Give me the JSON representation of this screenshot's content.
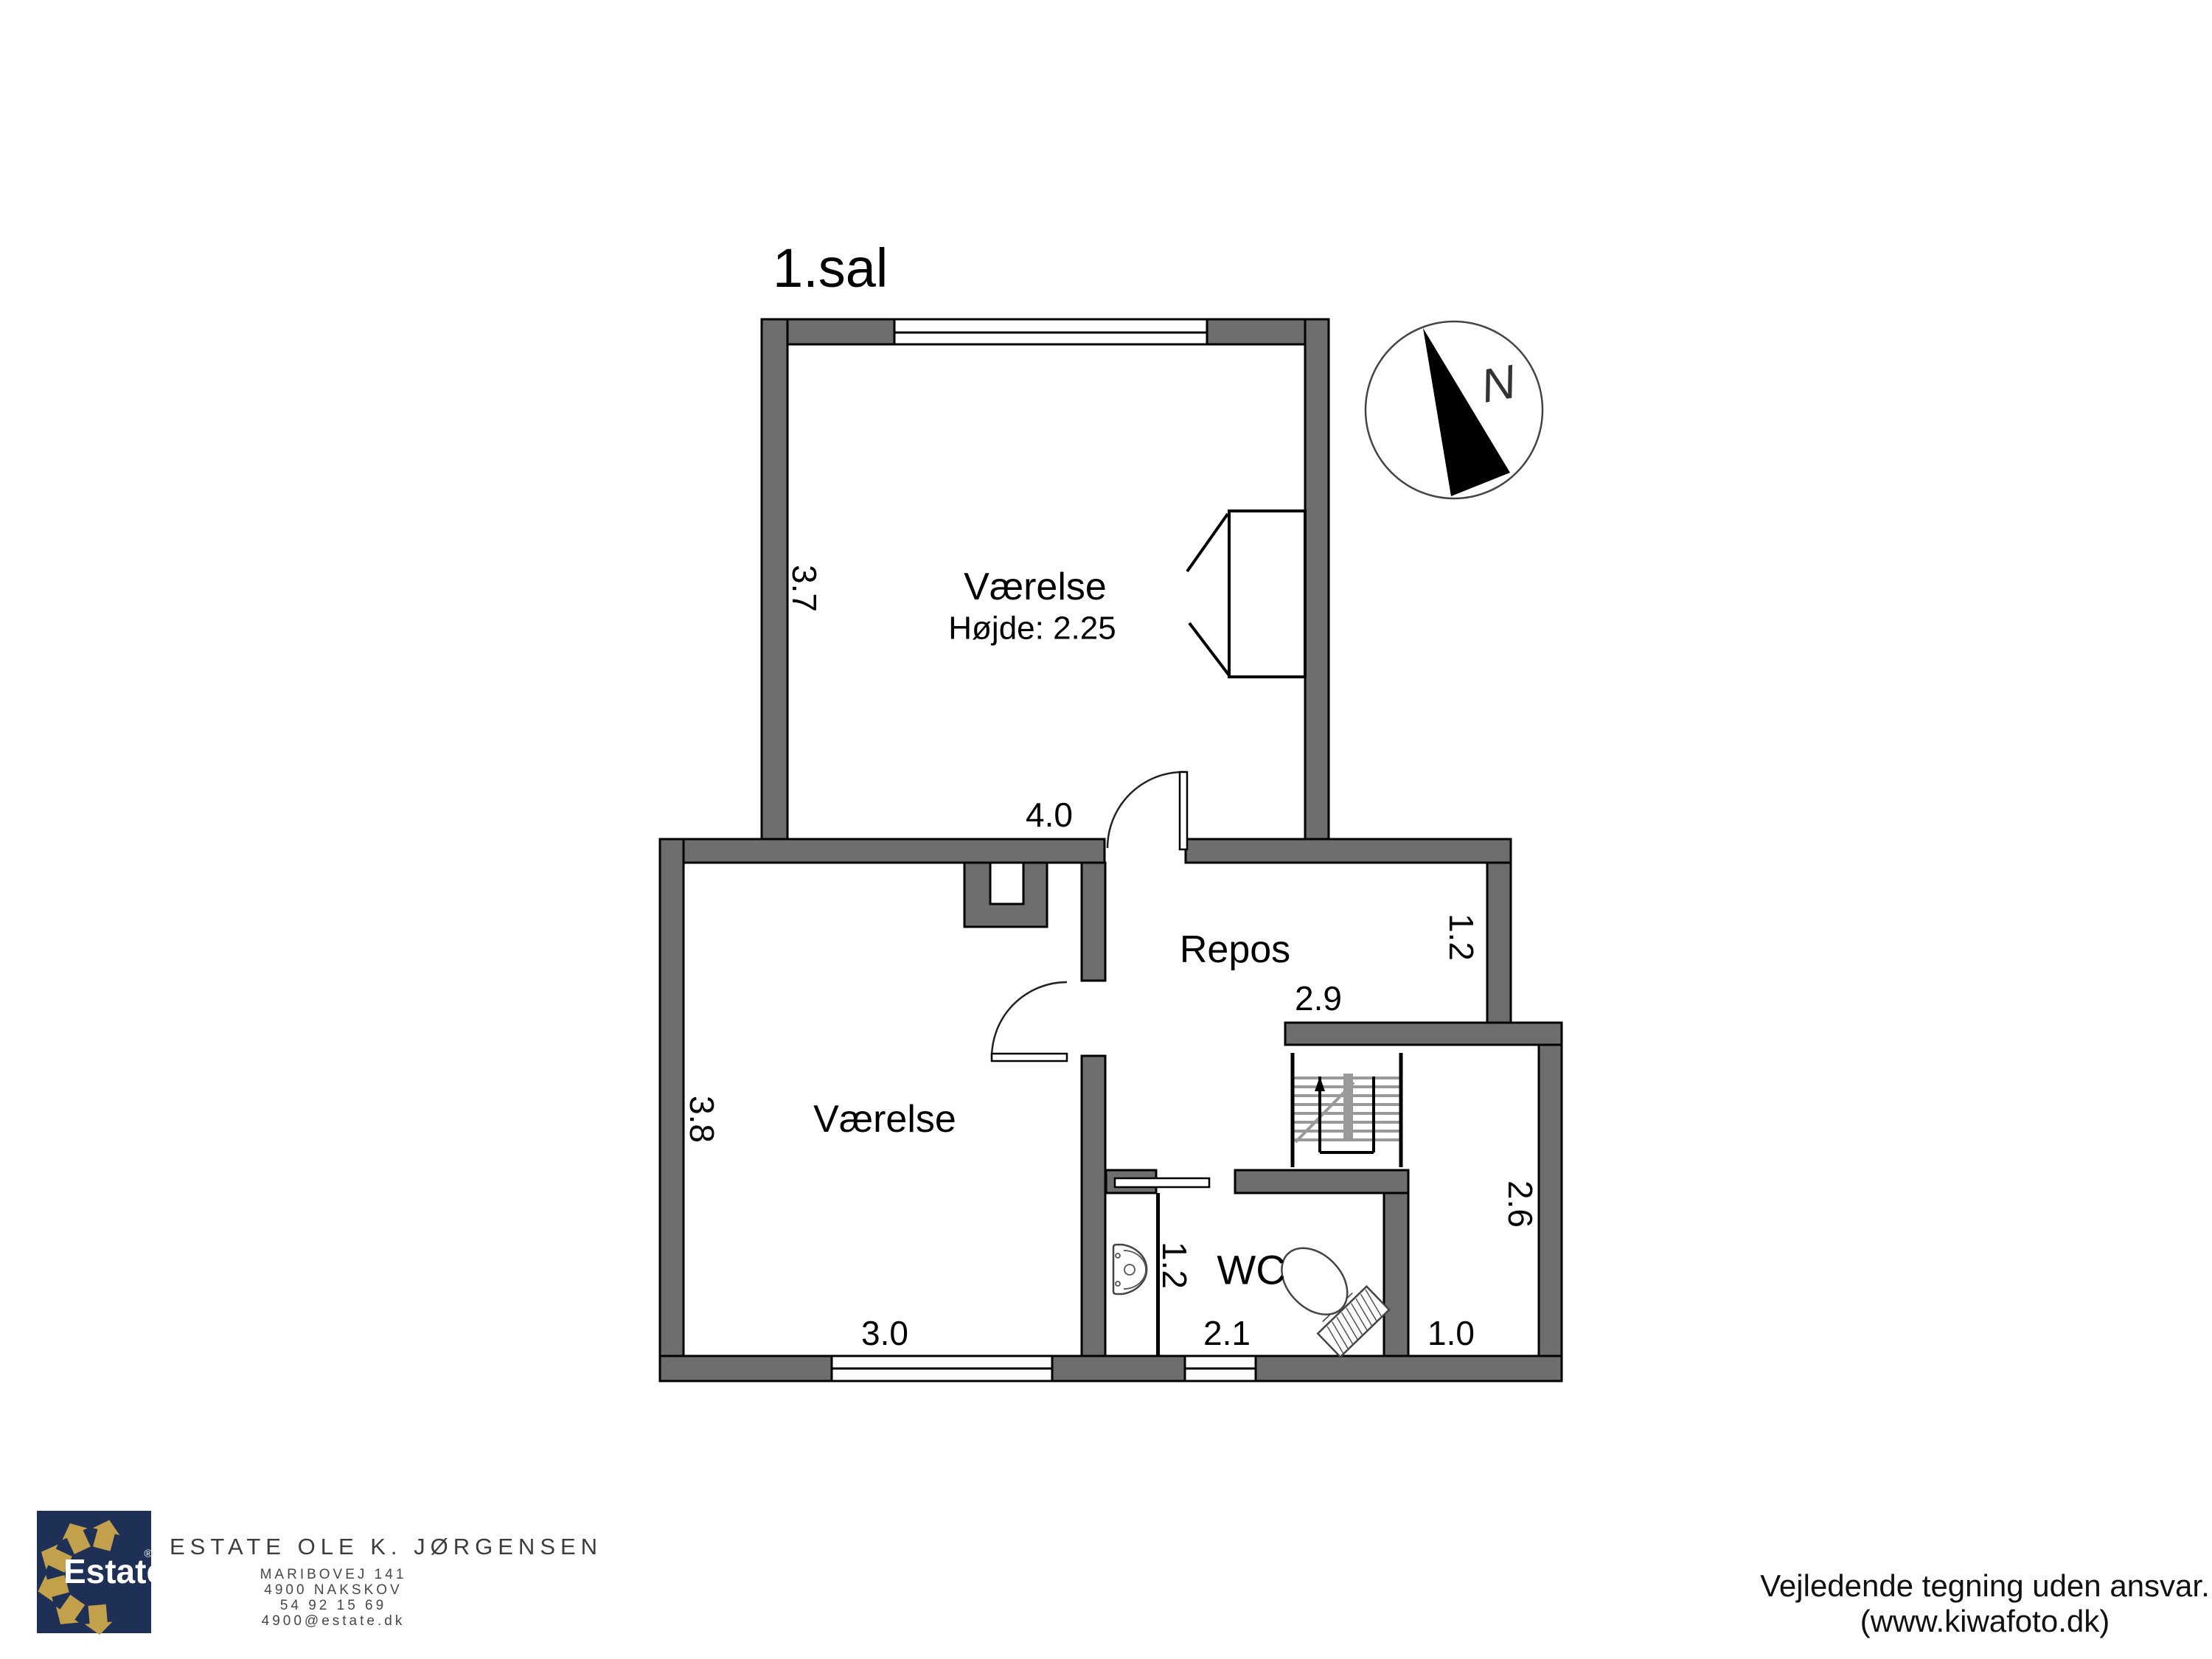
{
  "title": "1.sal",
  "compass": {
    "n": "N"
  },
  "rooms": {
    "upper": {
      "name": "Værelse",
      "height_note": "Højde: 2.25",
      "dim_width": "4.0",
      "dim_depth": "3.7"
    },
    "repos": {
      "name": "Repos",
      "dim_width": "2.9",
      "dim_depth": "1.2"
    },
    "lower": {
      "name": "Værelse",
      "dim_width": "3.0",
      "dim_depth": "3.8"
    },
    "wc": {
      "name": "WC",
      "dim_width": "2.1",
      "niche_width": "1.2"
    },
    "side": {
      "dim_width": "1.0",
      "dim_depth": "2.6"
    }
  },
  "footer": {
    "logo": {
      "brand": "Estate",
      "registered": "®"
    },
    "company": "ESTATE OLE K. JØRGENSEN",
    "address_lines": [
      "MARIBOVEJ 141",
      "4900 NAKSKOV",
      "54 92 15 69",
      "4900@estate.dk"
    ],
    "disclaimer_line1": "Vejledende tegning uden ansvar.",
    "disclaimer_line2": "(www.kiwafoto.dk)"
  },
  "colors": {
    "wall": "#6e6e6e",
    "line": "#000000",
    "navy": "#1e3055",
    "gold": "#c3a04c",
    "tread": "#9a9a9a",
    "footer_text": "#3d3d3d"
  }
}
